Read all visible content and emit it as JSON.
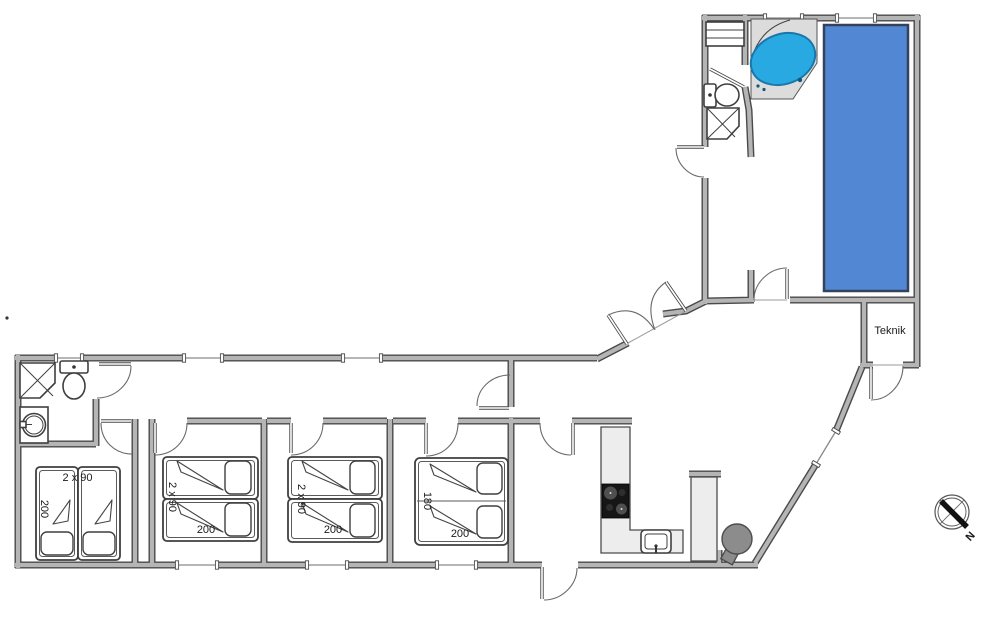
{
  "plan": {
    "teknik_room_label": "Teknik",
    "compass_north_label": "N"
  },
  "bedrooms": [
    {
      "id": "bedroom-1",
      "bed_width_label": "2 x 90",
      "bed_length_label": "200"
    },
    {
      "id": "bedroom-2",
      "bed_width_label": "2 x 90",
      "bed_length_label": "200"
    },
    {
      "id": "bedroom-3",
      "bed_width_label": "2 x 90",
      "bed_length_label": "200"
    },
    {
      "id": "bedroom-4",
      "bed_width_label": "180",
      "bed_length_label": "200"
    }
  ],
  "colors": {
    "pool_fill": "#5287d3",
    "pool_border": "#33435e",
    "tub_fill": "#29a9e2",
    "tub_border": "#1878ab",
    "wall_fill": "#b5b5b5",
    "wall_edge": "#4a4a4a",
    "counter_fill": "#ededed",
    "stove_fill": "#8c8c8c"
  }
}
